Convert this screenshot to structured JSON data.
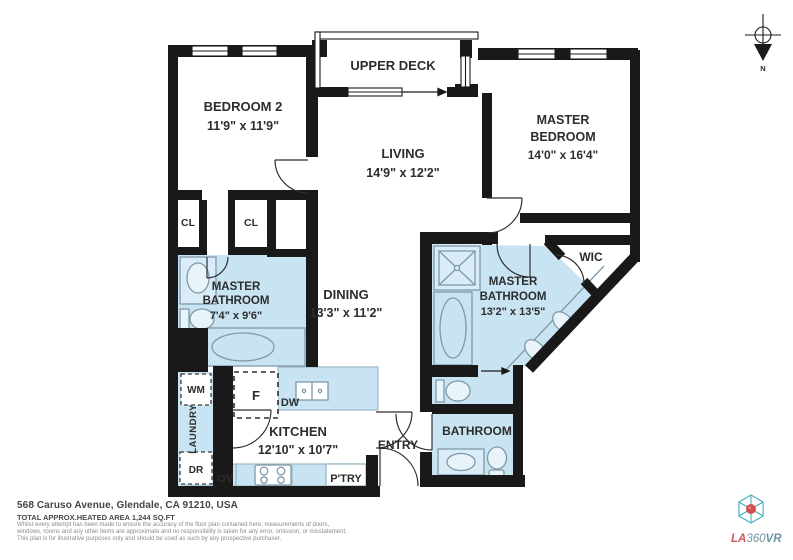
{
  "plan": {
    "rooms": {
      "upper_deck": {
        "name": "UPPER DECK"
      },
      "bedroom2": {
        "name": "BEDROOM 2",
        "dims": "11'9\" x 11'9\""
      },
      "living": {
        "name": "LIVING",
        "dims": "14'9\" x 12'2\""
      },
      "master_bedroom": {
        "name_l1": "MASTER",
        "name_l2": "BEDROOM",
        "dims": "14'0\" x 16'4\""
      },
      "master_bath_left": {
        "name_l1": "MASTER",
        "name_l2": "BATHROOM",
        "dims": "7'4\" x 9'6\""
      },
      "dining": {
        "name": "DINING",
        "dims": "13'3\" x 11'2\""
      },
      "master_bath_right": {
        "name_l1": "MASTER",
        "name_l2": "BATHROOM",
        "dims": "13'2\" x 13'5\""
      },
      "kitchen": {
        "name": "KITCHEN",
        "dims": "12'10\" x 10'7\""
      },
      "bathroom": {
        "name": "BATHROOM"
      },
      "entry": {
        "name": "ENTRY"
      },
      "wic": {
        "name": "WIC"
      }
    },
    "fixtures": {
      "cl": "CL",
      "wm": "WM",
      "dr": "DR",
      "laundry": "LAUNDRY",
      "fridge": "F",
      "dw": "DW",
      "ov": "OV",
      "pantry": "P'TRY"
    },
    "compass_n": "N"
  },
  "footer": {
    "address": "568 Caruso Avenue, Glendale, CA 91210, USA",
    "area": "TOTAL APPROX.HEATED AREA 1,244 SQ.FT",
    "disclaimer": [
      "Whilst every attempt has been made to ensure the accuracy of the floor plan contained here, measurements of doors,",
      "windows, rooms and any other items are approximate and no responsibility is taken for any error, omission, or misstatement.",
      "This plan is for illustrative purposes only and should be used as such by any prospective purchaser."
    ]
  },
  "logo": {
    "part1": "LA",
    "part2": "360",
    "part3": "VR"
  },
  "colors": {
    "wet_fill": "#c8e4f3",
    "wall": "#191919",
    "logo_red": "#d25455",
    "logo_teal": "#6f95a3"
  }
}
